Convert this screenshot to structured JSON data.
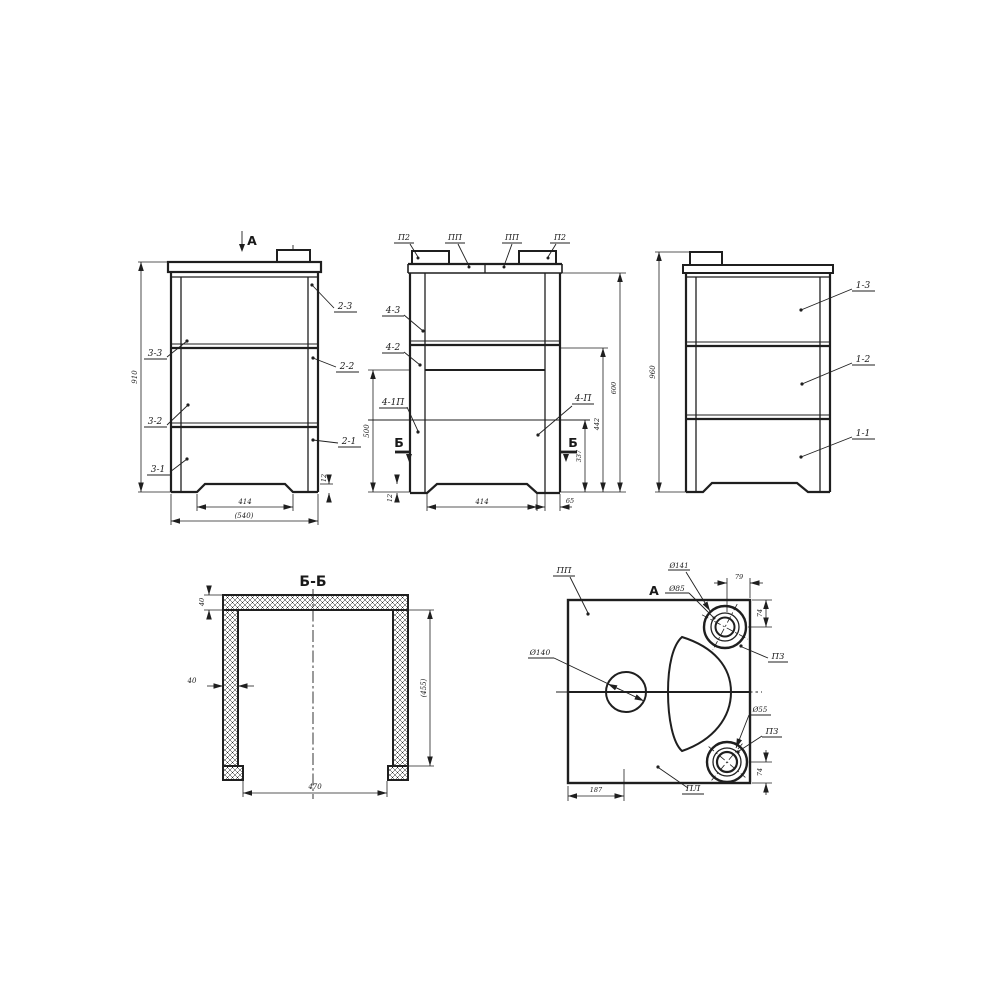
{
  "colors": {
    "background": "#ffffff",
    "line": "#1f1f1f"
  },
  "front_view": {
    "marker": "A",
    "left_labels": [
      "3-3",
      "3-2",
      "3-1"
    ],
    "right_labels": [
      "2-3",
      "2-2",
      "2-1"
    ],
    "dims": {
      "height": "910",
      "base_width": "414",
      "overall_width": "(540)",
      "leg_height": "12"
    }
  },
  "middle_view": {
    "top_labels": [
      "П2",
      "ПП",
      "ПП",
      "П2"
    ],
    "left_labels": [
      "4-3",
      "4-2",
      "4-1П"
    ],
    "right_label": "4-П",
    "section_letter": "Б",
    "dims": {
      "opening_height": "500",
      "leg_height": "12",
      "base_width": "414",
      "side_offset": "65",
      "h_inner": "337",
      "h_mid": "442",
      "h_outer": "600"
    }
  },
  "side_view": {
    "right_labels": [
      "1-3",
      "1-2",
      "1-1"
    ],
    "dims": {
      "height": "960"
    }
  },
  "section_bb": {
    "title": "Б-Б",
    "dims": {
      "top_wall": "40",
      "side_wall": "40",
      "inner_width": "470",
      "inner_height": "(455)"
    }
  },
  "top_view": {
    "marker": "A",
    "labels": {
      "top_left": "ПП",
      "bottom": "ПЛ",
      "ring_top": "ПЗ",
      "ring_bottom": "ПЗ"
    },
    "dims": {
      "dia_center": "Ø140",
      "dia_ring_outer": "Ø141",
      "dia_ring_top": "Ø85",
      "dia_ring_bottom": "Ø55",
      "top_offset": "79",
      "right_top": "74",
      "right_bottom": "74",
      "bottom_left": "187"
    }
  }
}
